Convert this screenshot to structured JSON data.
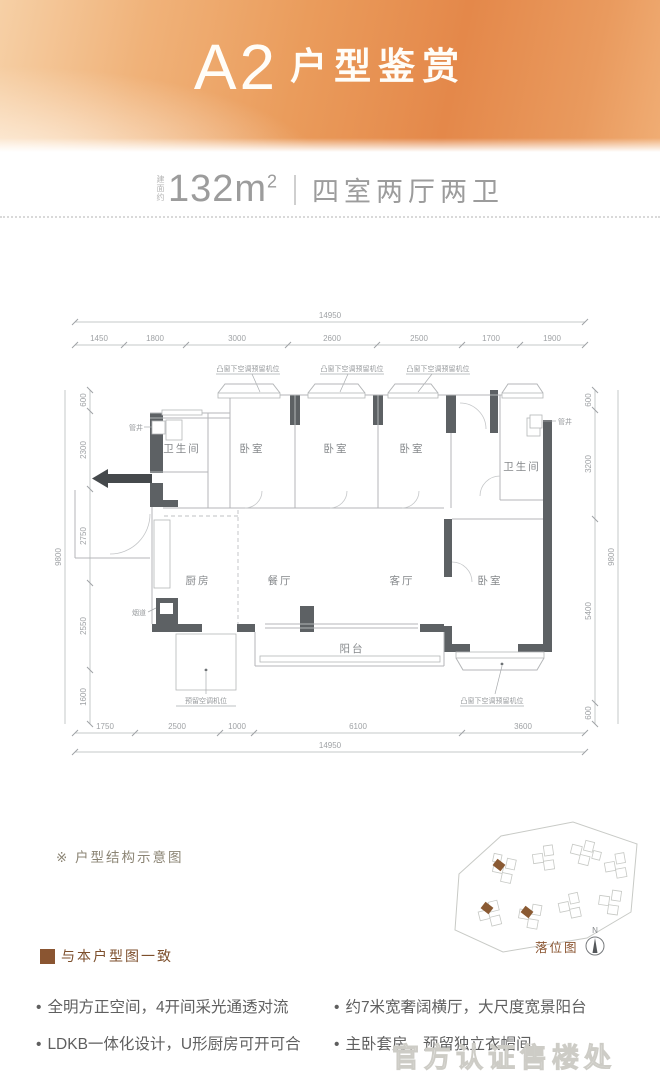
{
  "banner": {
    "unit_code": "A2",
    "title": "户型鉴赏"
  },
  "area": {
    "prefix": "建面约",
    "value": "132m",
    "sup": "2",
    "rooms": "四室两厅两卫"
  },
  "plan": {
    "top_total": "14950",
    "top_dims": [
      "1450",
      "1800",
      "3000",
      "2600",
      "2500",
      "1700",
      "1900"
    ],
    "left_total": "9800",
    "left_dims": [
      "600",
      "2300",
      "2750",
      "2550",
      "1600"
    ],
    "right_total": "9800",
    "right_dims": [
      "600",
      "3200",
      "5400",
      "600"
    ],
    "bottom_total": "14950",
    "bottom_dims": [
      "1750",
      "2500",
      "1000",
      "6100",
      "3600"
    ],
    "ac_top_labels": [
      "凸窗下空调预留机位",
      "凸窗下空调预留机位",
      "凸窗下空调预留机位"
    ],
    "ac_bottom_left": "预留空调机位",
    "ac_bottom_right": "凸窗下空调预留机位",
    "rooms": {
      "bath_left": "卫生间",
      "bed_1": "卧室",
      "bed_2": "卧室",
      "bed_3": "卧室",
      "bath_right": "卫生间",
      "kitchen": "厨房",
      "dining": "餐厅",
      "living": "客厅",
      "master": "卧室",
      "balcony": "阳台"
    },
    "labels": {
      "shaft_left": "管井",
      "shaft_right": "管井",
      "flue": "烟道"
    }
  },
  "notes": {
    "structure": "※ 户型结构示意图",
    "legend": "与本户型图一致"
  },
  "siteplan": {
    "label": "落位图",
    "compass_n": "N"
  },
  "features": [
    "全明方正空间，4开间采光通透对流",
    "LDKB一体化设计，U形厨房可开可合",
    "约7米宽奢阔横厅，大尺度宽景阳台",
    "主卧套房，预留独立衣帽间"
  ],
  "watermark": "官方认证售楼处",
  "colors": {
    "accent_orange": "#e4884a",
    "brown": "#8a5531",
    "wall": "#5d6164",
    "dim_text": "#9fa2a5"
  }
}
